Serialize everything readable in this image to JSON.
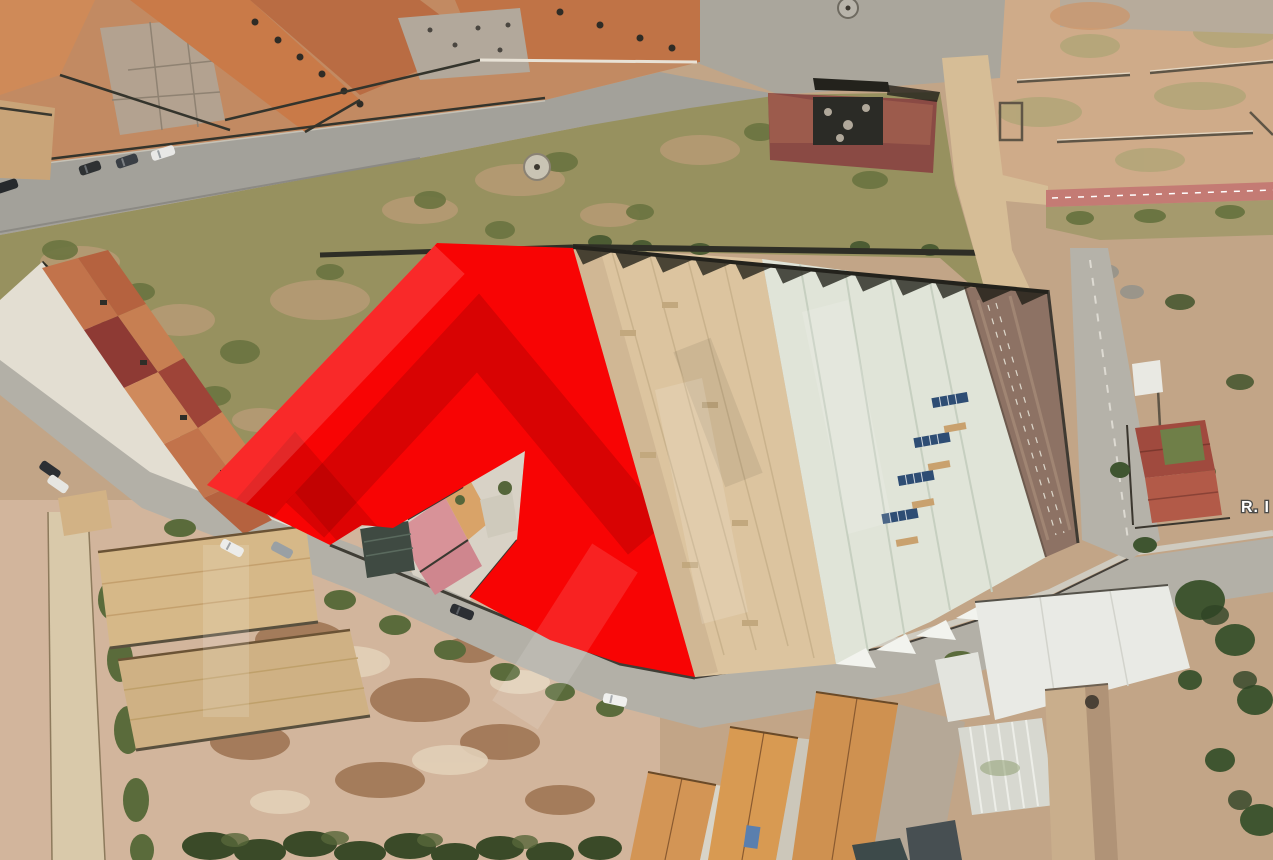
{
  "map": {
    "type": "aerial-satellite-photo",
    "street_label": "R. I",
    "overlay": {
      "label": "highlighted-parcel",
      "color": "#f80404",
      "points": "437,243 573,248 695,677 620,663 550,640 505,616 470,597 517,540 525,451 463,487 393,528 362,525 330,545 207,485"
    },
    "watermark": {
      "light": "rgba(255,255,255,0.14)",
      "dark": "rgba(0,0,0,0.12)"
    }
  }
}
